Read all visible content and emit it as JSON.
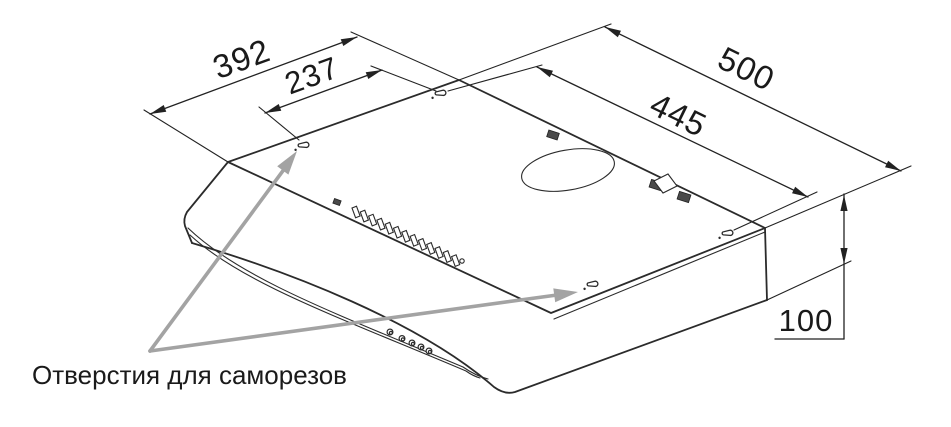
{
  "drawing": {
    "title_semantic": "cooker-hood-mounting-dimensions",
    "annotation_label": "Отверстия для саморезов",
    "dimensions": {
      "depth_total": "392",
      "hole_spacing_depth": "237",
      "width_total": "500",
      "hole_spacing_width": "445",
      "body_height": "100"
    },
    "colors": {
      "line": "#2b2b2b",
      "dimension": "#222222",
      "callout_arrow": "#a3a3a3",
      "text": "#1a1a1a",
      "background": "#ffffff"
    }
  }
}
